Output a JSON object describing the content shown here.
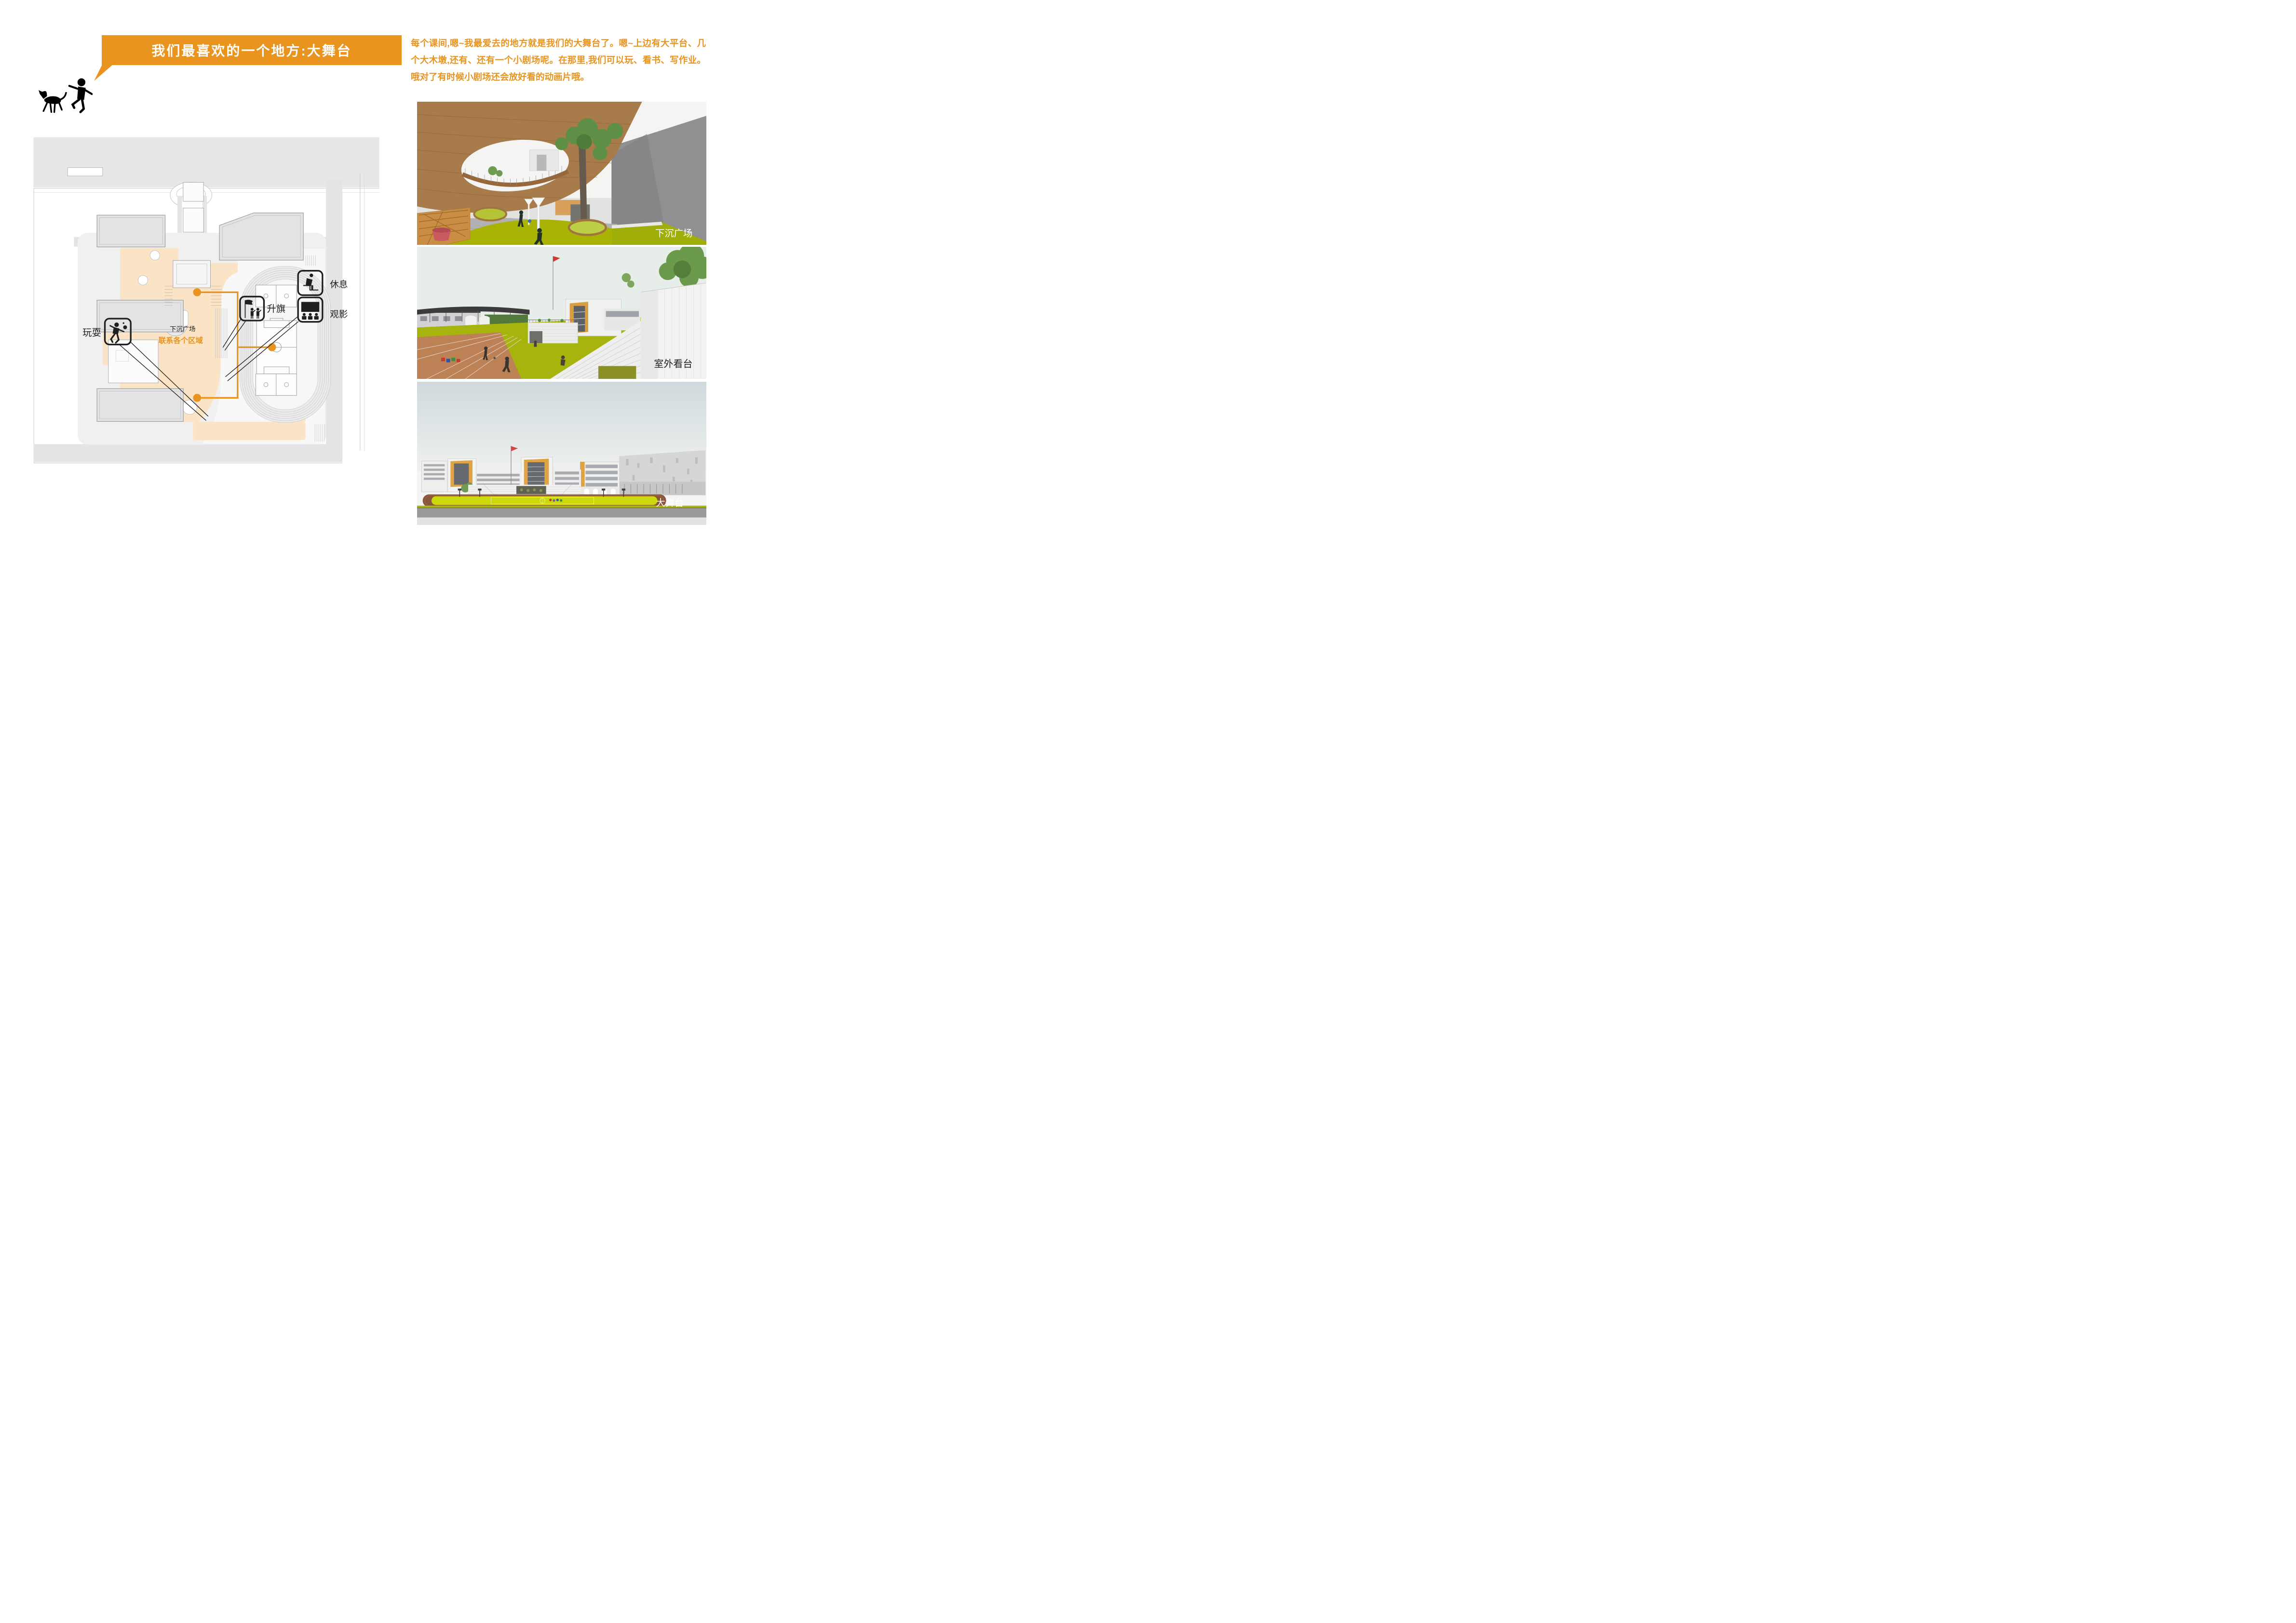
{
  "header": {
    "title": "我们最喜欢的一个地方:大舞台",
    "intro": "每个课间,嗯~我最爱去的地方就是我们的大舞台了。嗯~上边有大平台、几个大木墩,还有、还有一个小剧场呢。在那里,我们可以玩、看书、写作业。哦对了有时候小剧场还会放好看的动画片哦。"
  },
  "plan": {
    "callouts": {
      "play": "玩耍",
      "flag": "升旗",
      "rest": "休息",
      "movie": "观影"
    },
    "area_labels": {
      "sunken_plaza": "下沉广场",
      "connect": "联系各个区域"
    }
  },
  "renderings": [
    {
      "caption": "下沉广场"
    },
    {
      "caption": "室外看台"
    },
    {
      "caption": "大舞台"
    }
  ],
  "colors": {
    "accent_orange": "#E8941F",
    "plaza_peach": "#FBE3C6",
    "grass_green": "#AAB400",
    "track_brown": "#BD8156"
  }
}
